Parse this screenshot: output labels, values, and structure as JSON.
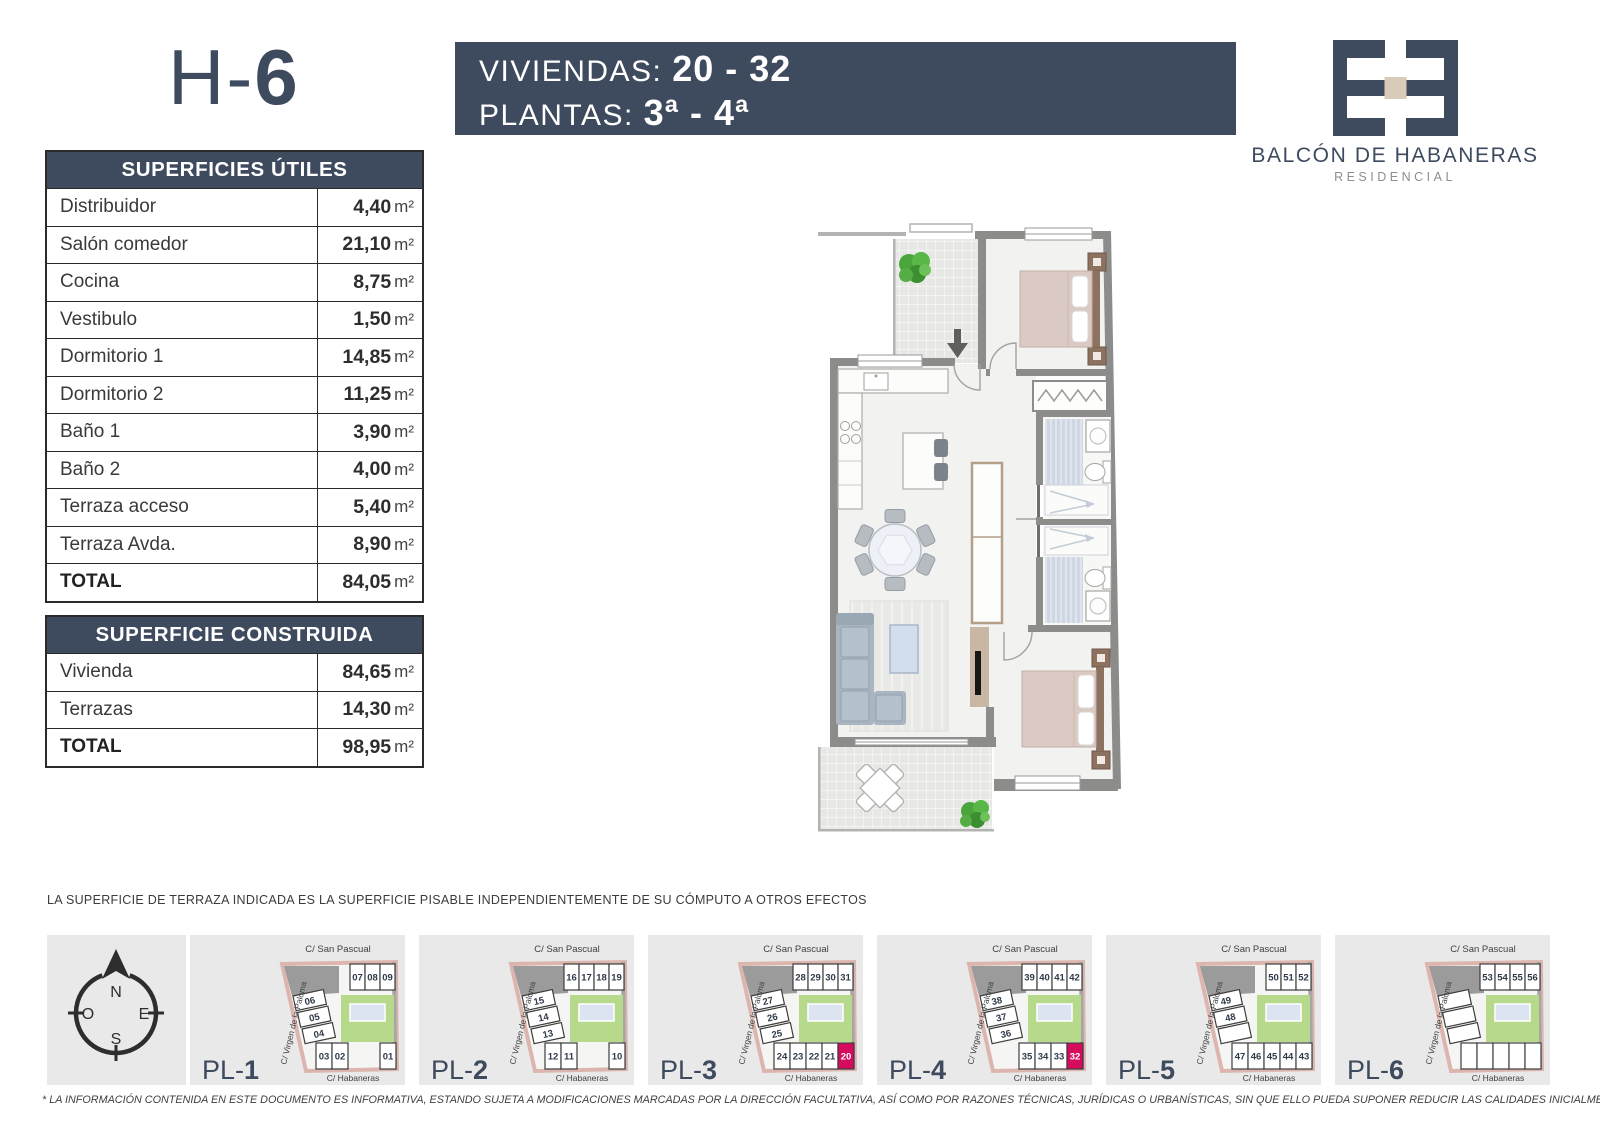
{
  "header": {
    "unit_prefix": "H-",
    "unit_number": "6",
    "viviendas_label": "VIVIENDAS: ",
    "viviendas_value": "20 - 32",
    "plantas_label": "PLANTAS: ",
    "plantas_value": "3ª - 4ª"
  },
  "brand": {
    "name": "BALCÓN DE HABANERAS",
    "subtitle": "RESIDENCIAL"
  },
  "tables": {
    "superficies_utiles": {
      "title": "SUPERFICIES ÚTILES",
      "unit": "m²",
      "rows": [
        {
          "label": "Distribuidor",
          "value": "4,40"
        },
        {
          "label": "Salón comedor",
          "value": "21,10"
        },
        {
          "label": "Cocina",
          "value": "8,75"
        },
        {
          "label": "Vestibulo",
          "value": "1,50"
        },
        {
          "label": "Dormitorio 1",
          "value": "14,85"
        },
        {
          "label": "Dormitorio 2",
          "value": "11,25"
        },
        {
          "label": "Baño 1",
          "value": "3,90"
        },
        {
          "label": "Baño 2",
          "value": "4,00"
        },
        {
          "label": "Terraza acceso",
          "value": "5,40"
        },
        {
          "label": "Terraza Avda.",
          "value": "8,90"
        }
      ],
      "total": {
        "label": "TOTAL",
        "value": "84,05"
      }
    },
    "superficie_construida": {
      "title": "SUPERFICIE CONSTRUIDA",
      "unit": "m²",
      "rows": [
        {
          "label": "Vivienda",
          "value": "84,65"
        },
        {
          "label": "Terrazas",
          "value": "14,30"
        }
      ],
      "total": {
        "label": "TOTAL",
        "value": "98,95"
      }
    }
  },
  "notes": {
    "terrace_note": "LA SUPERFICIE DE TERRAZA INDICADA ES LA SUPERFICIE PISABLE INDEPENDIENTEMENTE DE SU CÓMPUTO A OTROS EFECTOS",
    "disclaimer": "* LA INFORMACIÓN CONTENIDA EN ESTE DOCUMENTO ES INFORMATIVA, ESTANDO SUJETA A MODIFICACIONES MARCADAS POR LA DIRECCIÓN FACULTATIVA, ASÍ COMO POR RAZONES TÉCNICAS, JURÍDICAS O URBANÍSTICAS, SIN QUE ELLO PUEDA SUPONER REDUCIR LAS CALIDADES INICIALMENTE PREVISTAS."
  },
  "compass": {
    "north": "N",
    "south": "S",
    "east": "E",
    "west": "O"
  },
  "site_plans": {
    "streets": {
      "top": "C/ San  Pascual",
      "left": "C/ Virgen de la Paloma",
      "bottom": "C/ Habaneras"
    },
    "plans": [
      {
        "label_prefix": "PL-",
        "label_number": "1",
        "top": [
          "07",
          "08",
          "09"
        ],
        "left": [
          "06",
          "05",
          "04"
        ],
        "bottom": [
          "03",
          "02",
          null,
          null,
          "01"
        ],
        "highlight": null
      },
      {
        "label_prefix": "PL-",
        "label_number": "2",
        "top": [
          "16",
          "17",
          "18",
          "19"
        ],
        "left": [
          "15",
          "14",
          "13"
        ],
        "bottom": [
          "12",
          "11",
          null,
          null,
          "10"
        ],
        "highlight": null
      },
      {
        "label_prefix": "PL-",
        "label_number": "3",
        "top": [
          "28",
          "29",
          "30",
          "31"
        ],
        "left": [
          "27",
          "26",
          "25"
        ],
        "bottom": [
          "24",
          "23",
          "22",
          "21",
          "20"
        ],
        "highlight": "20"
      },
      {
        "label_prefix": "PL-",
        "label_number": "4",
        "top": [
          "39",
          "40",
          "41",
          "42"
        ],
        "left": [
          "38",
          "37",
          "36"
        ],
        "bottom": [
          null,
          "35",
          "34",
          "33",
          "32"
        ],
        "highlight": "32"
      },
      {
        "label_prefix": "PL-",
        "label_number": "5",
        "top": [
          "50",
          "51",
          "52"
        ],
        "left": [
          "49",
          "48",
          ""
        ],
        "bottom": [
          "47",
          "46",
          "45",
          "44",
          "43"
        ],
        "highlight": null
      },
      {
        "label_prefix": "PL-",
        "label_number": "6",
        "top": [
          "53",
          "54",
          "55",
          "56"
        ],
        "left": [
          "",
          "",
          ""
        ],
        "bottom": [
          "",
          "",
          "",
          "",
          ""
        ],
        "highlight": null
      }
    ]
  },
  "colors": {
    "navy": "#3e4a5e",
    "magenta": "#d60b5e",
    "panel_gray": "#e9e9e9",
    "site_green": "#b7d98b",
    "pool_blue": "#dce3f1",
    "logo_beige": "#d9cbb8",
    "wall_gray": "#8c8c8a"
  }
}
